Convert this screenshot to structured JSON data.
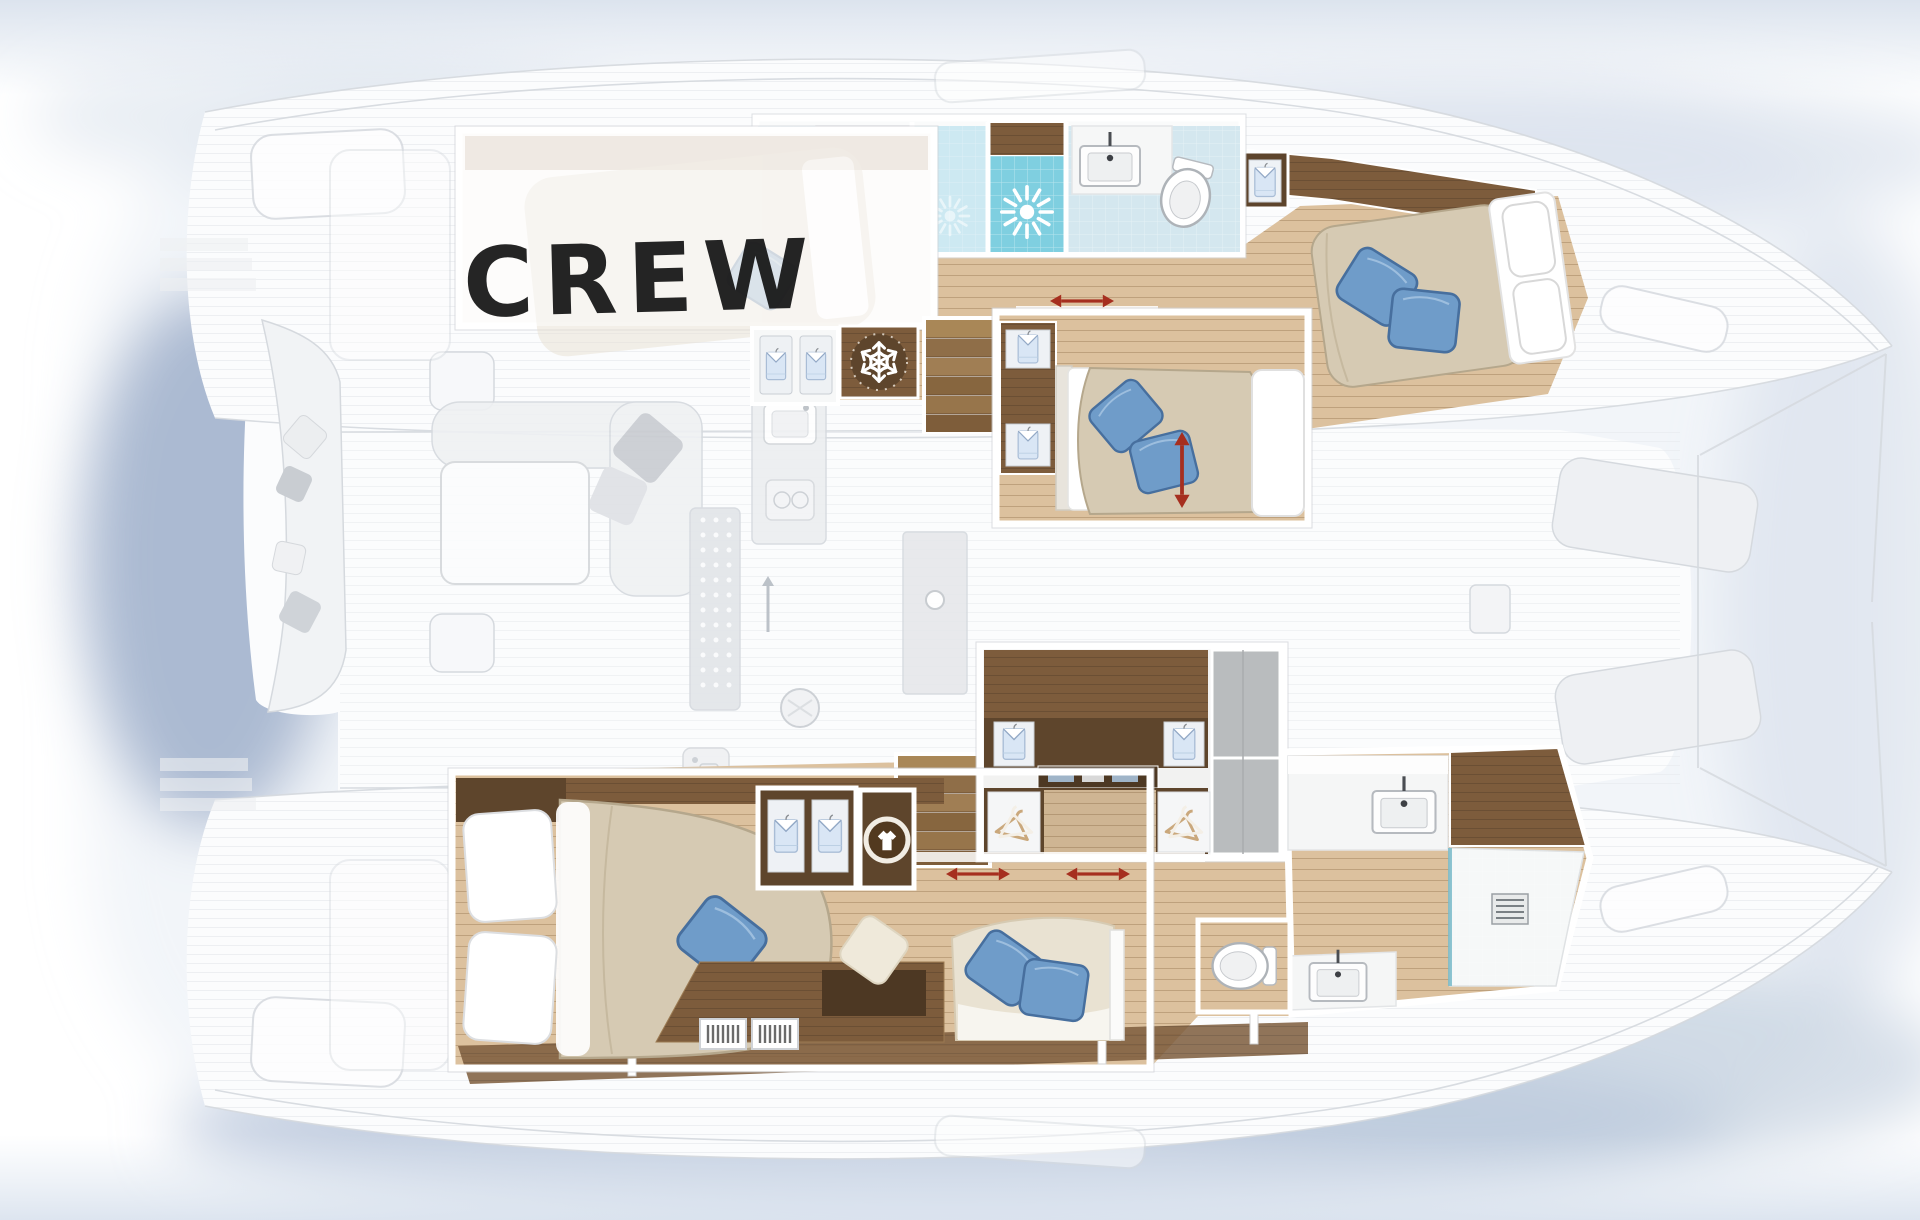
{
  "labels": {
    "crew": "CREW"
  },
  "icons": {
    "snowflake": "refrigerator",
    "shirt": "wardrobe-locker",
    "hangers": "hanging-wardrobe",
    "washing_machine": "washing-machine",
    "shower_spray": "shower",
    "sink": "washbasin",
    "toilet": "toilet",
    "sliding_door_arrow": "sliding-door-direction"
  },
  "colors": {
    "page_bg": "#ffffff",
    "shadow_blue": "#a9bad4",
    "ghost_fill": "#f1f3f5",
    "ghost_line": "#d5d9de",
    "wood_light": "#dcc19e",
    "wood_line": "#b08a5e",
    "wood_panel": "#7d5c3c",
    "wood_dark": "#5e452c",
    "wood_tread": "#96744c",
    "bed_beige": "#d6cab3",
    "bed_shadow": "#b5a78c",
    "pillow_blue": "#6f9cc9",
    "pillow_blue_dark": "#476f9e",
    "tile_light": "#d4e7ef",
    "tile_mid": "#bfe2ee",
    "tile_deep": "#7fcfe0",
    "arrow_red": "#a62f1f",
    "text_black": "#151515"
  }
}
